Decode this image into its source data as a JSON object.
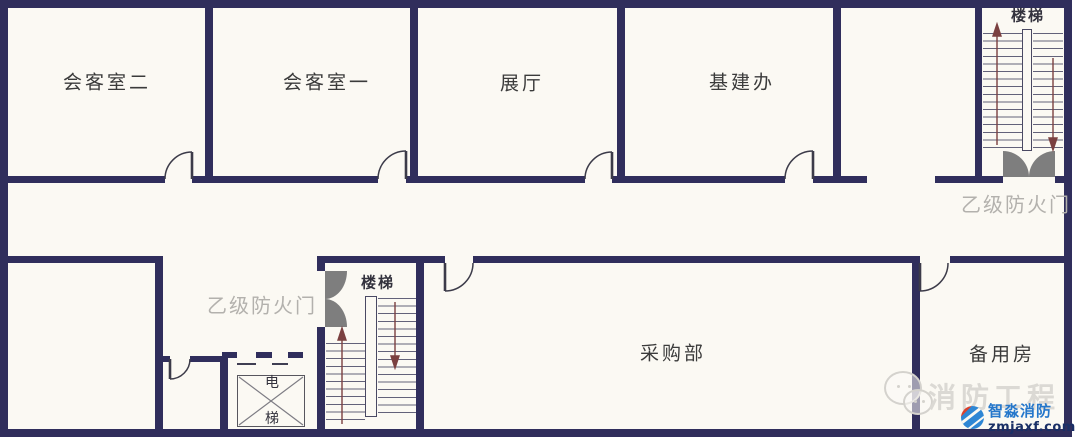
{
  "diagram_type": "floor_plan",
  "building": {
    "rooms": [
      {
        "id": "meeting-room-2",
        "label": "会客室二"
      },
      {
        "id": "meeting-room-1",
        "label": "会客室一"
      },
      {
        "id": "exhibition-hall",
        "label": "展厅"
      },
      {
        "id": "infrastructure-office",
        "label": "基建办"
      },
      {
        "id": "procurement-dept",
        "label": "采购部"
      },
      {
        "id": "spare-room",
        "label": "备用房"
      }
    ],
    "stairs": [
      {
        "id": "stairs-top-right",
        "label": "楼梯"
      },
      {
        "id": "stairs-middle",
        "label": "楼梯"
      }
    ],
    "elevator": {
      "label_line1": "电",
      "label_line2": "梯"
    },
    "fire_doors": [
      {
        "id": "fire-door-top-right",
        "label": "乙级防火门"
      },
      {
        "id": "fire-door-middle",
        "label": "乙级防火门"
      }
    ]
  },
  "watermark": {
    "text": "消防工程",
    "brand_name": "智淼消防",
    "brand_url": "zmjaxf.com"
  },
  "colors": {
    "wall": "#302e5c",
    "background": "#fbf9f3",
    "fire_door_leaf": "#7e7e7e",
    "stair_arrow": "#7b4040",
    "fire_door_label": "#b3b1ad",
    "room_label": "#3b3b3b",
    "watermark_gray": "#dbd9d4",
    "brand_blue": "#2577cb",
    "brand_dark_blue": "#1a2f66"
  }
}
